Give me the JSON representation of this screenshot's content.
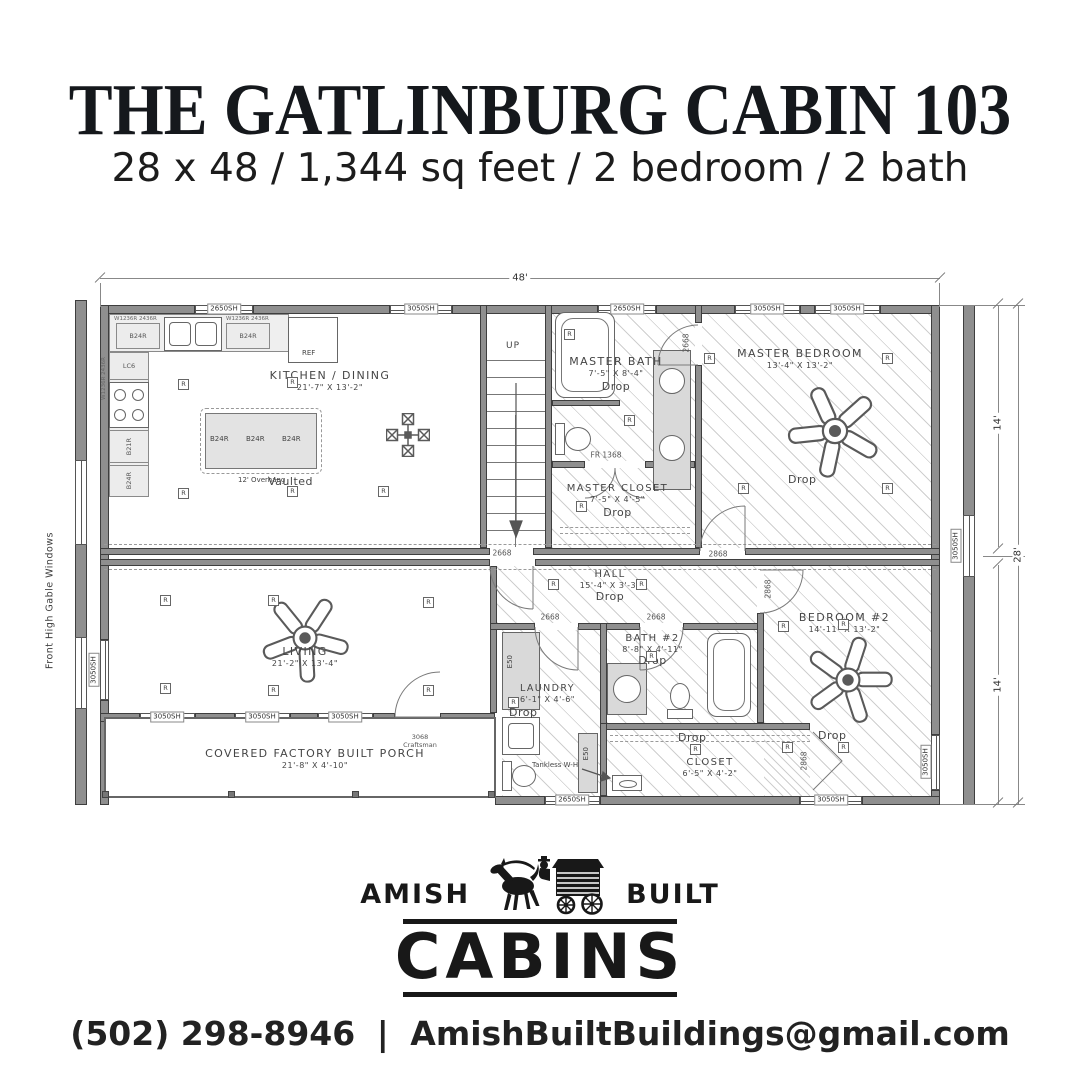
{
  "header": {
    "title": "THE GATLINBURG CABIN 103",
    "subtitle": "28 x 48 / 1,344 sq feet / 2 bedroom / 2 bath"
  },
  "plan": {
    "dims": {
      "width_ft": "48'",
      "module_ft": "14'",
      "total_ft": "28'"
    },
    "side_note": "Front High Gable Windows",
    "window_labels": {
      "large": "3050SH",
      "small": "2650SH"
    },
    "door_labels": {
      "d2668": "2668",
      "d2868": "2868",
      "craftsman": "3068 Craftsman",
      "closet_pair": "FR 1368"
    },
    "labels": {
      "up": "UP",
      "receptacle": "R",
      "vaulted": "Vaulted",
      "drop": "Drop",
      "tankless": "Tankless W-H",
      "ref": "REF",
      "island_note": "12' Overhang",
      "e50": "E50"
    },
    "cabinets": {
      "b24r": "B24R",
      "b21r": "B21R",
      "lc6": "LC6",
      "wall_note": "W1236R 2436R"
    },
    "rooms": [
      {
        "name": "KITCHEN / DINING",
        "dims": "21'-7\" X 13'-2\""
      },
      {
        "name": "MASTER BATH",
        "dims": "7'-5\" X 8'-4\""
      },
      {
        "name": "MASTER CLOSET",
        "dims": "7'-5\" X 4'-5\""
      },
      {
        "name": "MASTER BEDROOM",
        "dims": "13'-4\" X 13'-2\""
      },
      {
        "name": "HALL",
        "dims": "15'-4\" X 3'-3\""
      },
      {
        "name": "LIVING",
        "dims": "21'-2\" X 13'-4\""
      },
      {
        "name": "LAUNDRY",
        "dims": "6'-1\" X 4'-6\""
      },
      {
        "name": "BATH #2",
        "dims": "8'-8\" X 4'-11\""
      },
      {
        "name": "CLOSET",
        "dims": "6'-5\" X 4'-2\""
      },
      {
        "name": "BEDROOM #2",
        "dims": "14'-11\" X 13'-2\""
      },
      {
        "name": "COVERED FACTORY BUILT PORCH",
        "dims": "21'-8\" X 4'-10\""
      }
    ]
  },
  "logo": {
    "word_left": "AMISH",
    "word_right": "BUILT",
    "brand": "CABINS"
  },
  "footer": {
    "phone": "(502) 298-8946",
    "separator": "|",
    "email": "AmishBuiltBuildings@gmail.com"
  }
}
